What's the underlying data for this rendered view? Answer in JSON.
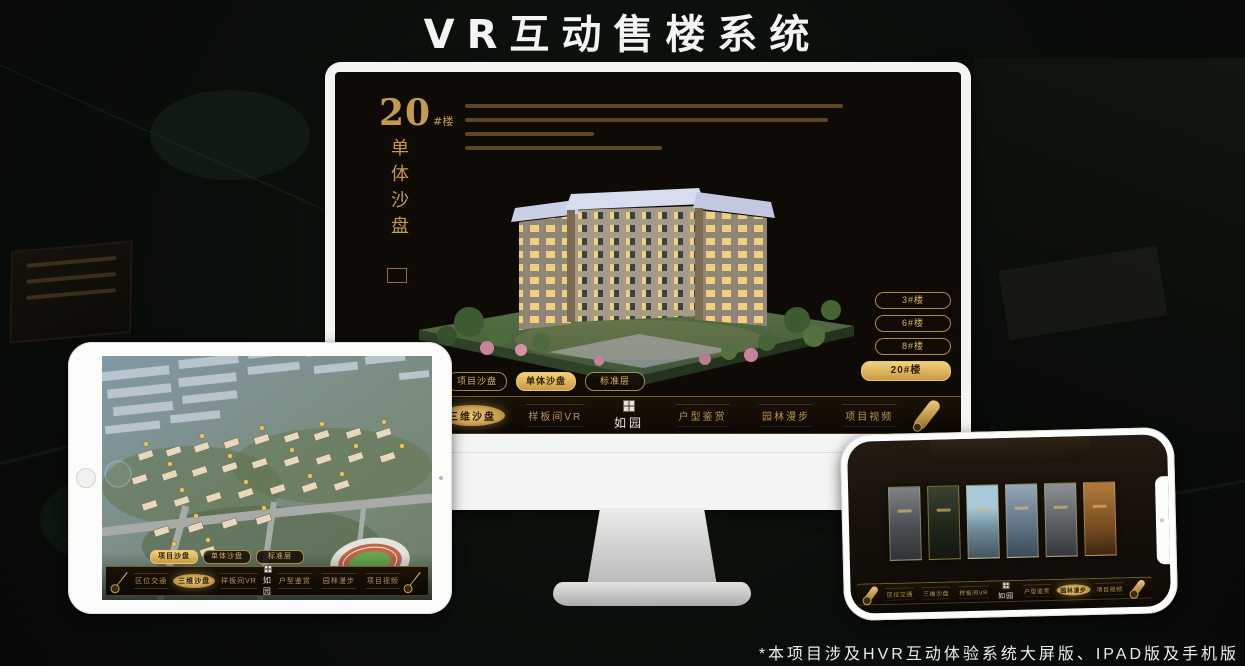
{
  "page": {
    "title": "VR互动售楼系统",
    "footnote": "*本项目涉及HVR互动体验系统大屏版、IPAD版及手机版"
  },
  "sales_ui": {
    "block": {
      "number": "20",
      "suffix": "#楼",
      "subtitle": "单体沙盘"
    },
    "floor_buttons": [
      {
        "label": "3#楼",
        "active": false
      },
      {
        "label": "6#楼",
        "active": false
      },
      {
        "label": "8#楼",
        "active": false
      },
      {
        "label": "20#楼",
        "active": true
      }
    ],
    "view_tabs": [
      {
        "label": "项目沙盘"
      },
      {
        "label": "单体沙盘"
      },
      {
        "label": "标准层"
      }
    ],
    "nav": {
      "logo": "如园",
      "items": [
        {
          "label": "区位交通"
        },
        {
          "label": "三维沙盘"
        },
        {
          "label": "样板间VR"
        },
        {
          "label": "户型鉴赏"
        },
        {
          "label": "园林漫步"
        },
        {
          "label": "项目视频"
        }
      ]
    }
  },
  "devices": {
    "monitor": {
      "active_view_tab": "单体沙盘",
      "active_nav_item": "三维沙盘",
      "active_floor": "20#楼"
    },
    "tablet": {
      "active_view_tab": "项目沙盘",
      "active_nav_item": "三维沙盘"
    },
    "phone": {
      "active_nav_item": "园林漫步"
    }
  },
  "colors": {
    "gold": "#c9a35f",
    "gold_bright": "#eecb7c",
    "screen_bg": "#0e0b07",
    "active_text": "#2b1d07"
  }
}
